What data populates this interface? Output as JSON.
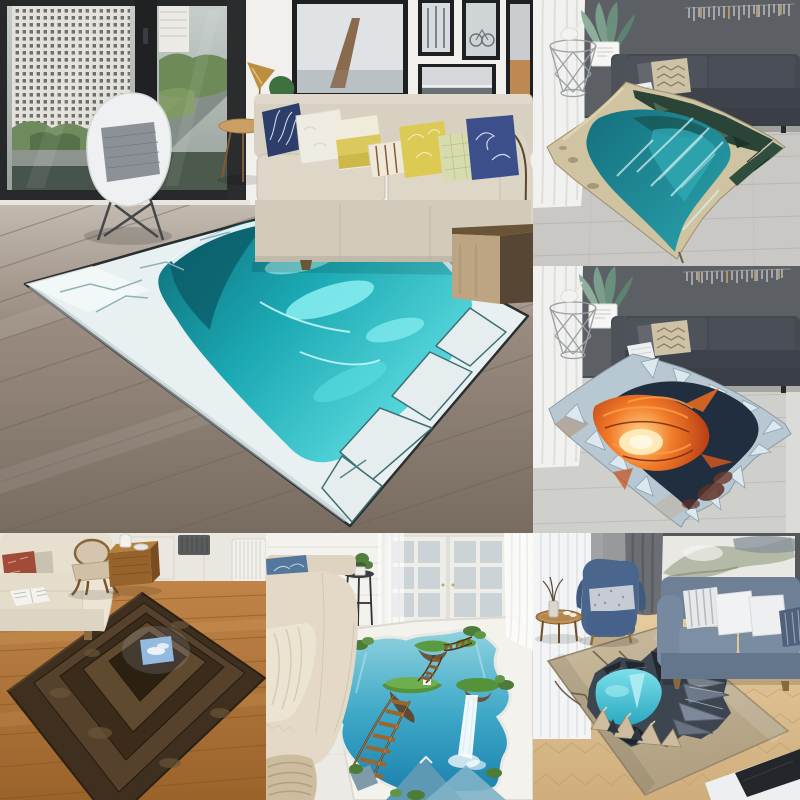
{
  "page": {
    "type": "product-photo-collage",
    "subject": "3D vision illusion area rugs staged in six living-room photos",
    "visible_text": "",
    "tile_count": 6
  },
  "palette": {
    "wall-white": "#f2f0ed",
    "wall-dark": "#5c6065",
    "wall-grey": "#97999b",
    "wall-panel-white": "#eae7e1",
    "floor-tile": "#c9c8c5",
    "floor-pale": "#eceae5",
    "sofa-beige": "#d8d0c1",
    "sofa-charcoal": "#464a50",
    "sofa-cream": "#e7e0d1",
    "sofa-bluegrey": "#6d8096",
    "chair-denim": "#4a668c",
    "ice-white": "#e9f0f1",
    "pit-teal-deep": "#0d6b78",
    "pit-teal": "#1ba8b2",
    "pit-cyan": "#62e0e4",
    "lagoon-deep": "#15707e",
    "lagoon-teal": "#2aa3ad",
    "cliff-green": "#2a4537",
    "sand": "#cfc3a2",
    "lava-deep": "#b23712",
    "lava-orange": "#f07a28",
    "lava-glow": "#ffda8c",
    "crater-navy": "#202e40",
    "stone-dark": "#3e2f1f",
    "sky": "#8cb6de",
    "island-green": "#55923c",
    "rug-tan": "#c2b194",
    "pool-teal": "#3cc2d6"
  },
  "tiles": [
    {
      "label": "Living room with floor-to-ceiling city window, beige sofa, white armchair and turquoise ice-cave pit illusion rug"
    },
    {
      "label": "Dark grey sofa room with wire side table, agave plant and teal canyon lagoon pit illusion rug"
    },
    {
      "label": "Dark grey sofa room with wire side table, agave plant and volcanic lava crater illusion rug"
    },
    {
      "label": "Country living room with cream sofa, oak floor and stone tunnel-to-sky illusion rug"
    },
    {
      "label": "Bright room with beige sofa and white rug showing floating islands, rope bridges and waterfall illusion"
    },
    {
      "label": "Grey-blue sofa room with herringbone floor and tan rug showing cracked rock teal pool illusion"
    }
  ]
}
